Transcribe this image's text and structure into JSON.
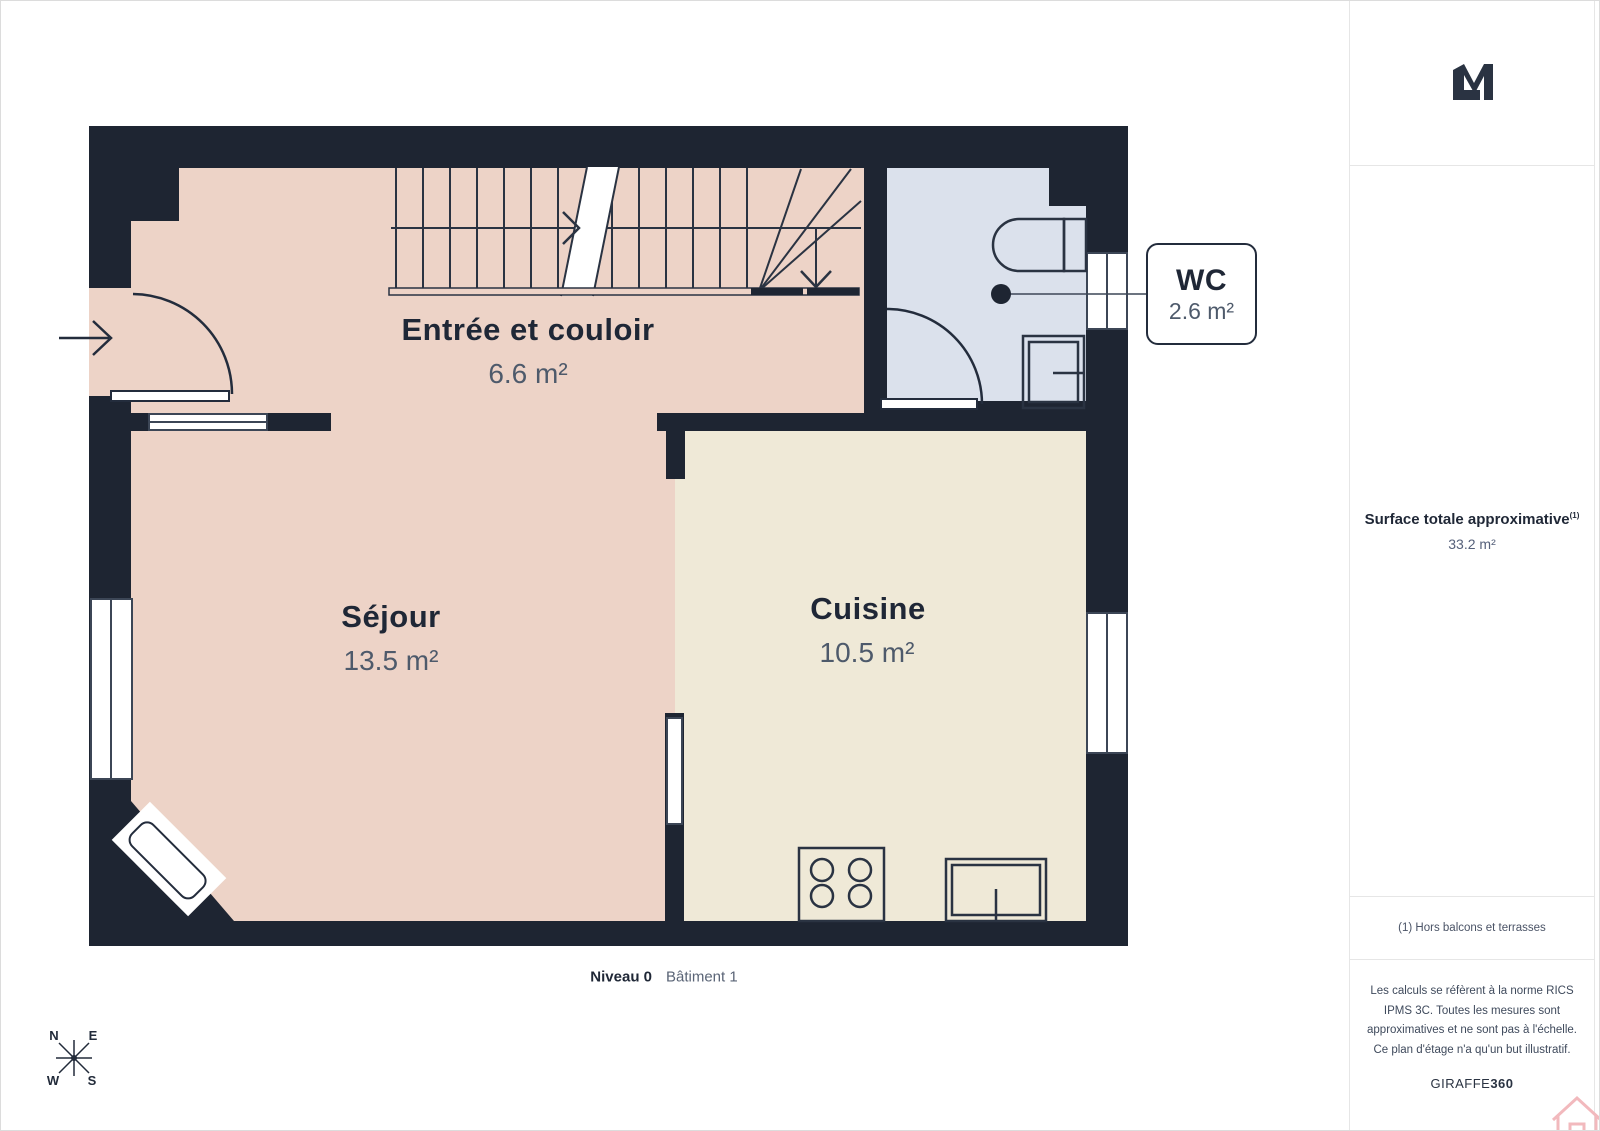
{
  "plan": {
    "rooms": [
      {
        "name": "Entrée et couloir",
        "area": "6.6 m²",
        "floor_color": "#edd3c7"
      },
      {
        "name": "Séjour",
        "area": "13.5 m²",
        "floor_color": "#edd3c7"
      },
      {
        "name": "Cuisine",
        "area": "10.5 m²",
        "floor_color": "#efe9d7"
      },
      {
        "name": "WC",
        "area": "2.6 m²",
        "floor_color": "#dbe1ec"
      }
    ],
    "level_label": "Niveau 0",
    "building_label": "Bâtiment 1",
    "compass": {
      "n": "N",
      "e": "E",
      "w": "W",
      "s": "S"
    }
  },
  "sidebar": {
    "logo_icon": "lm-monogram-logo",
    "surface_label": "Surface totale approximative",
    "surface_sup": "(1)",
    "surface_value": "33.2 m²",
    "footnote": "(1) Hors balcons et terrasses",
    "disclaimer": "Les calculs se réfèrent à la norme RICS IPMS 3C. Toutes les mesures sont approximatives et ne sont pas à l'échelle. Ce plan d'étage n'a qu'un but illustratif.",
    "brand": "GIRAFFE",
    "brand_bold": "360"
  },
  "colors": {
    "wall": "#1e2532",
    "floor_pink": "#edd3c7",
    "floor_cream": "#efe9d7",
    "floor_blue": "#dbe1ec",
    "room_name_text": "#1f2736",
    "room_area_text": "#4e5a6b",
    "house_icon_pink": "#f2b9bd"
  }
}
